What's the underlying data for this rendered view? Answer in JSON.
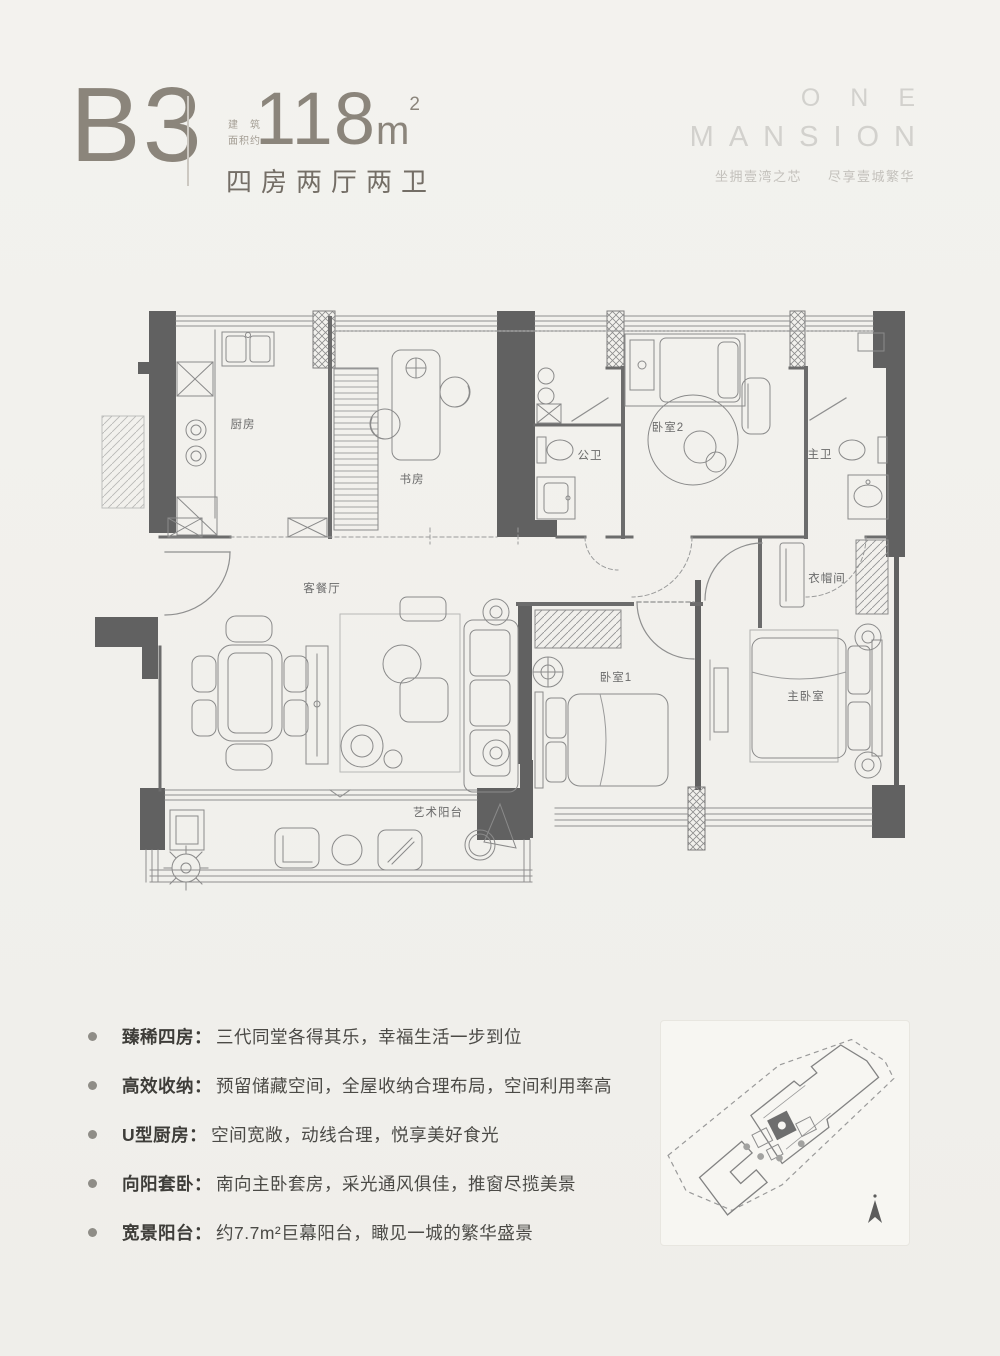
{
  "header": {
    "unit_code": "B3",
    "area_note_line1": "建筑",
    "area_note_line2": "面积约",
    "area_value": "118",
    "area_unit": "m",
    "area_sup": "2",
    "layout_text": "四房两厅两卫"
  },
  "brand": {
    "logo_line1": "ONE",
    "logo_line2": "MANSION",
    "tagline_left": "坐拥壹湾之芯",
    "tagline_right": "尽享壹城繁华"
  },
  "plan": {
    "rooms": [
      {
        "label": "厨房"
      },
      {
        "label": "书房"
      },
      {
        "label": "公卫"
      },
      {
        "label": "卧室2"
      },
      {
        "label": "主卫"
      },
      {
        "label": "客餐厅"
      },
      {
        "label": "衣帽间"
      },
      {
        "label": "卧室1"
      },
      {
        "label": "主卧室"
      },
      {
        "label": "艺术阳台"
      }
    ]
  },
  "features": [
    {
      "label": "臻稀四房：",
      "text": "三代同堂各得其乐，幸福生活一步到位"
    },
    {
      "label": "高效收纳：",
      "text": "预留储藏空间，全屋收纳合理布局，空间利用率高"
    },
    {
      "label": "U型厨房：",
      "text": "空间宽敞，动线合理，悦享美好食光"
    },
    {
      "label": "向阳套卧：",
      "text": "南向主卧套房，采光通风俱佳，推窗尽揽美景"
    },
    {
      "label": "宽景阳台：",
      "text": "约7.7m²巨幕阳台，瞰见一城的繁华盛景"
    }
  ],
  "colors": {
    "page_background": "#f2f1ed",
    "wall_fill": "#616161",
    "line_gray": "#8f8f8f",
    "accent_taupe": "#8b857b",
    "text_dark": "#4b4a46",
    "logo_gray": "#d2d1cd"
  }
}
